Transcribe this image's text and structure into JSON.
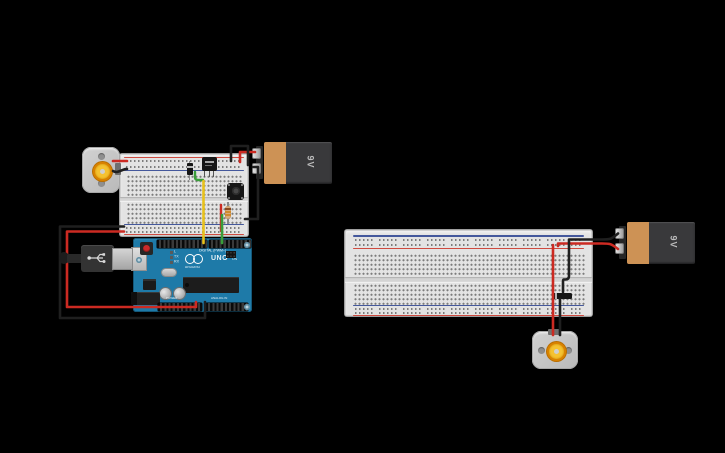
{
  "app": {
    "background": "#000000"
  },
  "left_circuit": {
    "battery": {
      "label": "9V"
    },
    "arduino": {
      "model": "UNO",
      "brand": "ARDUINO",
      "digital_label": "DIGITAL (PWM~)",
      "power_label": "POWER",
      "analog_label": "ANALOG IN",
      "on_label": "ON",
      "led_labels": [
        "L",
        "TX",
        "RX"
      ]
    }
  },
  "right_circuit": {
    "battery": {
      "label": "9V"
    }
  },
  "colors": {
    "wire_red": "#cc2a22",
    "wire_black": "#1f1f1f",
    "wire_green": "#3a9e3a",
    "wire_yellow": "#e8c21b",
    "arduino_blue": "#1e7aa8",
    "breadboard": "#e3e3e3",
    "battery_body": "#39393b",
    "battery_band": "#cd9255",
    "rail_red": "#cf4a3f",
    "rail_blue": "#44589c"
  }
}
